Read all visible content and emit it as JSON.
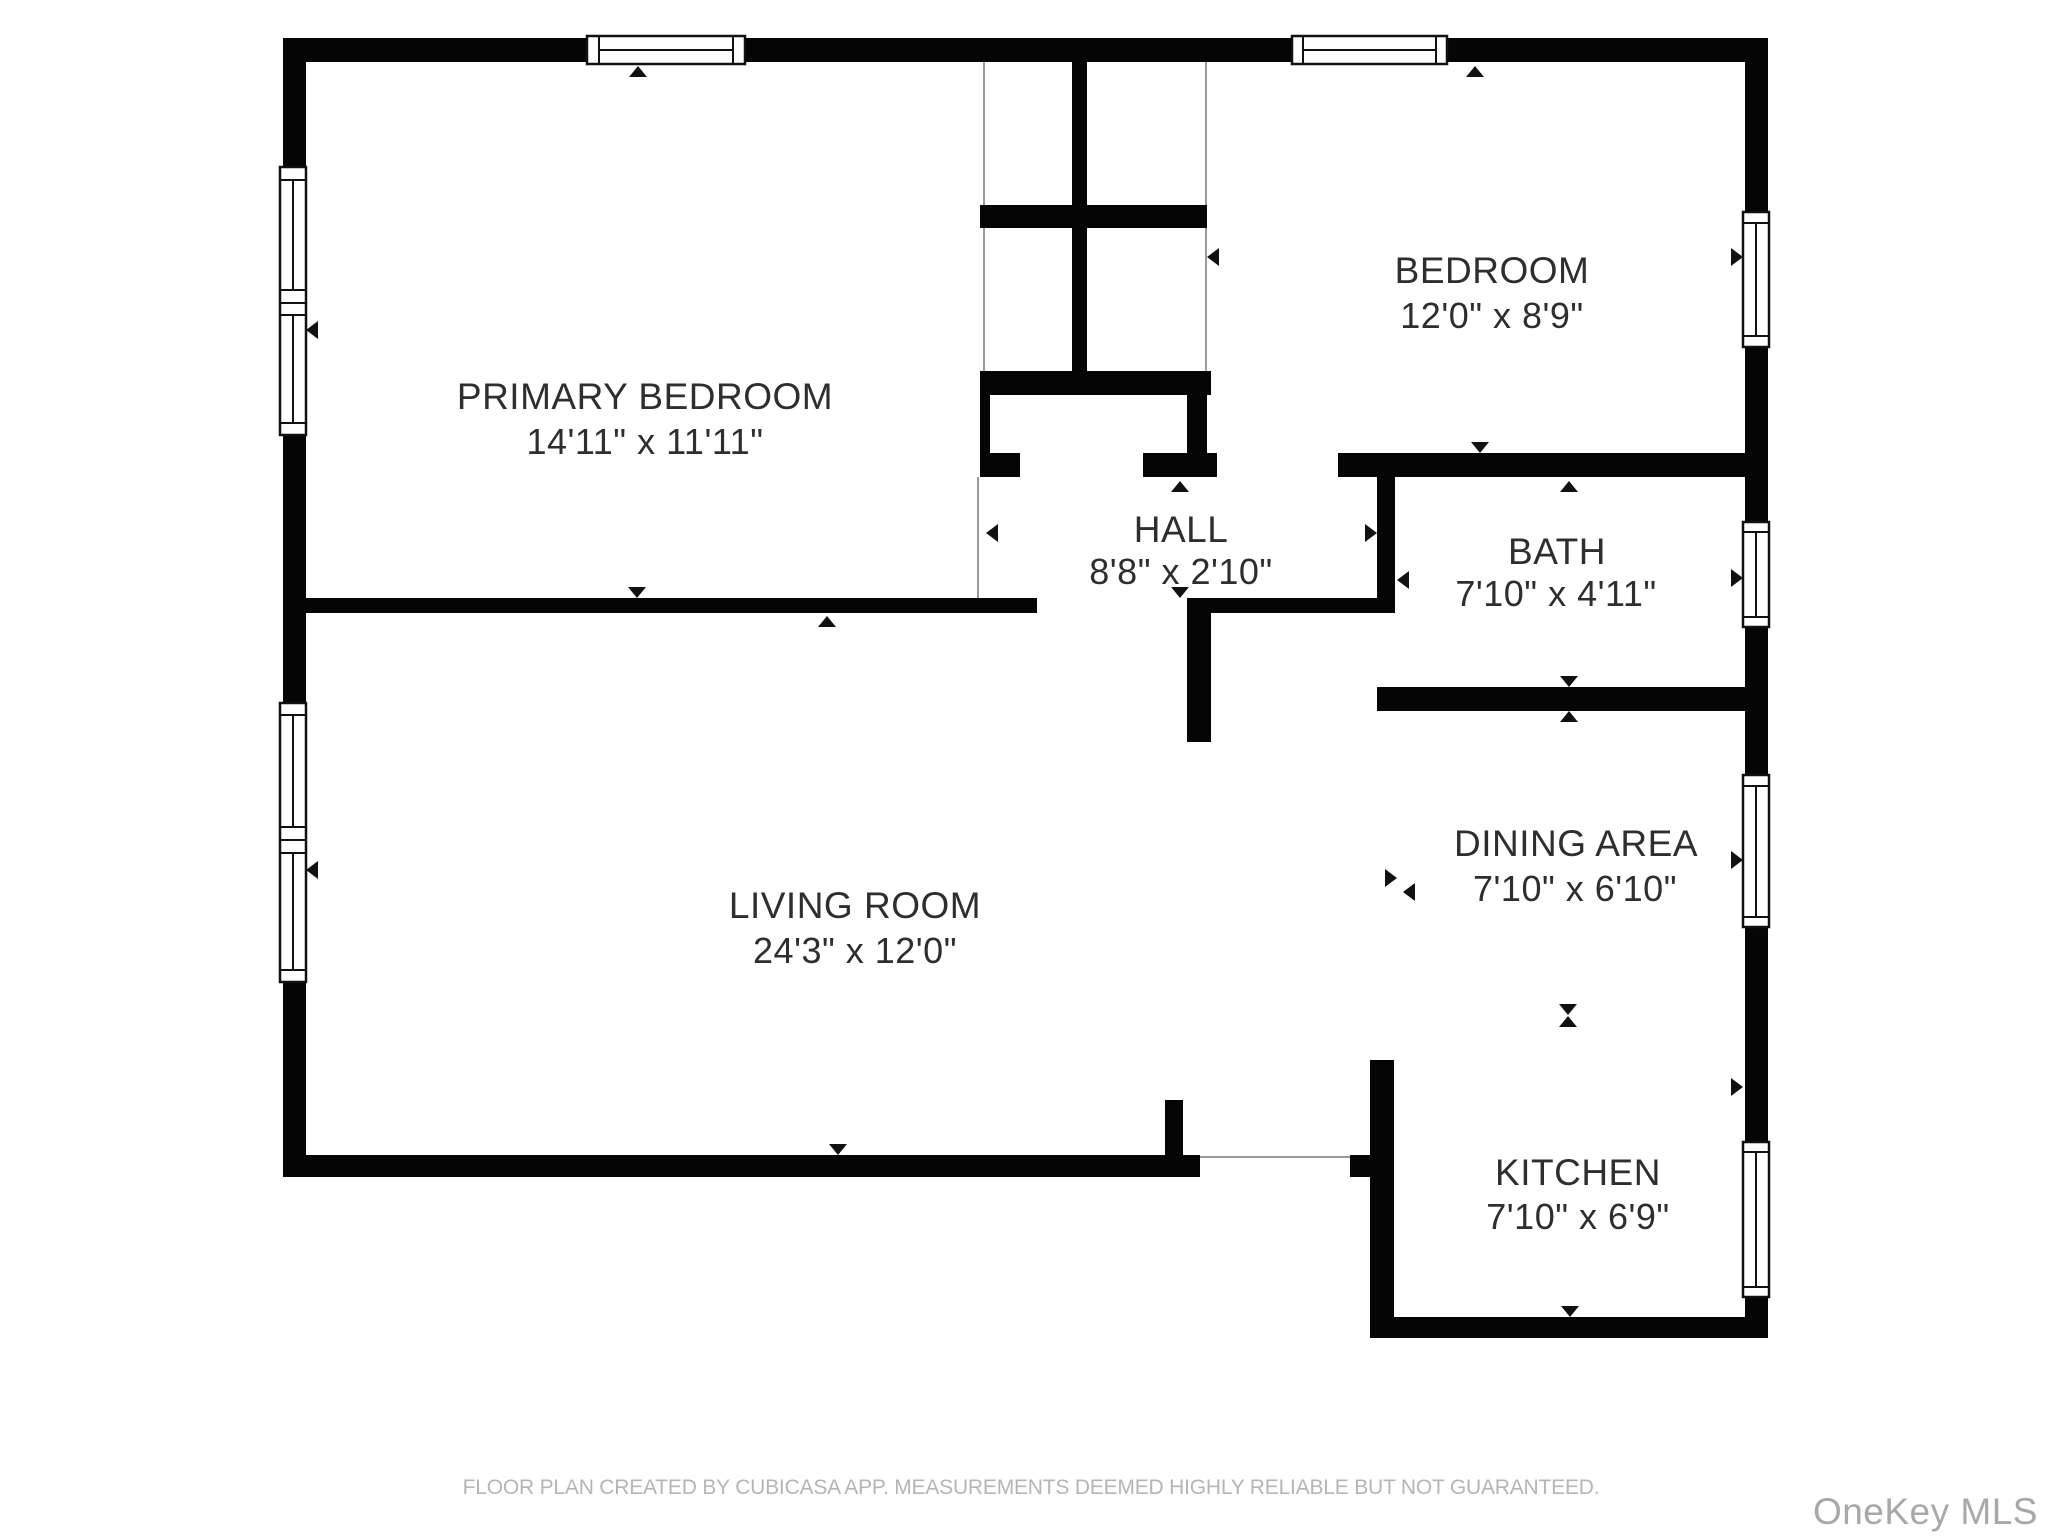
{
  "floor_plan": {
    "rooms": [
      {
        "id": "primary-bedroom",
        "name": "PRIMARY BEDROOM",
        "dimensions": "14'11\" x 11'11\""
      },
      {
        "id": "bedroom",
        "name": "BEDROOM",
        "dimensions": "12'0\" x 8'9\""
      },
      {
        "id": "hall",
        "name": "HALL",
        "dimensions": "8'8\" x 2'10\""
      },
      {
        "id": "bath",
        "name": "BATH",
        "dimensions": "7'10\" x 4'11\""
      },
      {
        "id": "living-room",
        "name": "LIVING ROOM",
        "dimensions": "24'3\" x 12'0\""
      },
      {
        "id": "dining-area",
        "name": "DINING AREA",
        "dimensions": "7'10\" x 6'10\""
      },
      {
        "id": "kitchen",
        "name": "KITCHEN",
        "dimensions": "7'10\" x 6'9\""
      }
    ],
    "footer": "FLOOR PLAN CREATED BY CUBICASA APP. MEASUREMENTS DEEMED HIGHLY RELIABLE BUT NOT GUARANTEED.",
    "watermark": "OneKey MLS",
    "colors": {
      "wall": "#050505",
      "label": "#2e2e2e",
      "footer": "#b5b5b5",
      "watermark": "#a8a8a8",
      "background": "#ffffff"
    }
  }
}
